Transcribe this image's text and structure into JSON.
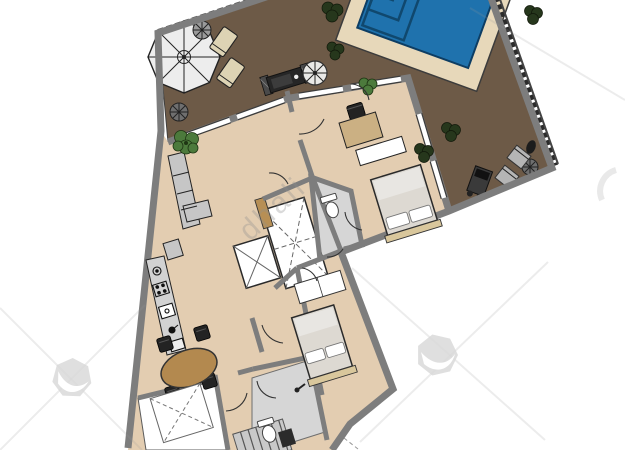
{
  "document": {
    "kind": "apartment-floor-plan-top-view",
    "orientation_degrees": -17
  },
  "watermark": {
    "text": "dhali",
    "text_color": "#8f8f8f",
    "logo_color": "#d9d9d9"
  },
  "colors": {
    "terrace_floor": "#6d5a47",
    "interior_floor": "#e3cdb1",
    "wall": "#7d7d7d",
    "pool_water": "#1f72ad",
    "pool_steps": "#10486e",
    "pool_deck": "#e7d8ba",
    "bathroom_floor": "#d6d6d6",
    "closet_floor": "#ffffff",
    "furniture_wood": "#b3894f",
    "furniture_tan": "#cbb083",
    "sofa_gray": "#c6c6c6",
    "bed_linen": "#ddd9d2",
    "plant_green": "#4c7a3c",
    "parasol": "#ededed",
    "lounger": "#ddd3b4",
    "railing": "#2b2b2b",
    "wm_text": "#8f8f8f",
    "wm_logo": "#d9d9d9"
  }
}
